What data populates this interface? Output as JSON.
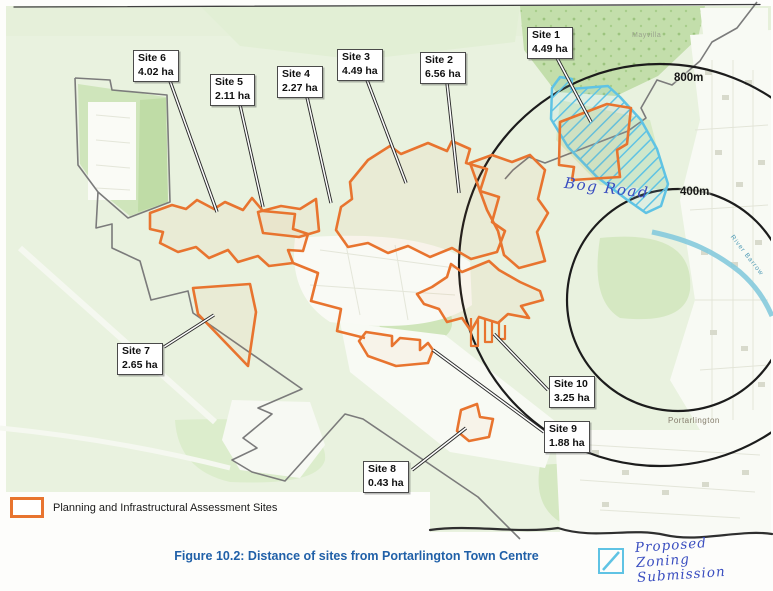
{
  "figure_caption": "Figure 10.2: Distance of sites from Portarlington Town Centre",
  "legend": {
    "assessment_sites_label": "Planning and Infrastructural Assessment Sites"
  },
  "sites": [
    {
      "name": "Site 1",
      "area": "4.49 ha"
    },
    {
      "name": "Site 2",
      "area": "6.56 ha"
    },
    {
      "name": "Site 3",
      "area": "4.49 ha"
    },
    {
      "name": "Site 4",
      "area": "2.27 ha"
    },
    {
      "name": "Site 5",
      "area": "2.11 ha"
    },
    {
      "name": "Site 6",
      "area": "4.02 ha"
    },
    {
      "name": "Site 7",
      "area": "2.65 ha"
    },
    {
      "name": "Site 8",
      "area": "0.43 ha"
    },
    {
      "name": "Site 9",
      "area": "1.88 ha"
    },
    {
      "name": "Site 10",
      "area": "3.25 ha"
    }
  ],
  "rings": [
    {
      "label": "800m"
    },
    {
      "label": "400m"
    }
  ],
  "place_labels": {
    "town": "Portarlington",
    "estate": "Mayvilla",
    "river": "River Barrow"
  },
  "handwritten": {
    "bog_road": "Bog Road",
    "proposed_lines": [
      "Proposed",
      "Zoning",
      "Submission"
    ]
  },
  "colors": {
    "site_outline": "#E8742F",
    "proposed_hatch": "#5FC3E4",
    "handwriting_ink": "#3A4EC0",
    "caption_blue": "#2060A8",
    "ring_black": "#1C1C1C",
    "boundary_grey": "#7B7B7B",
    "map_green": "#E9F2DF"
  }
}
